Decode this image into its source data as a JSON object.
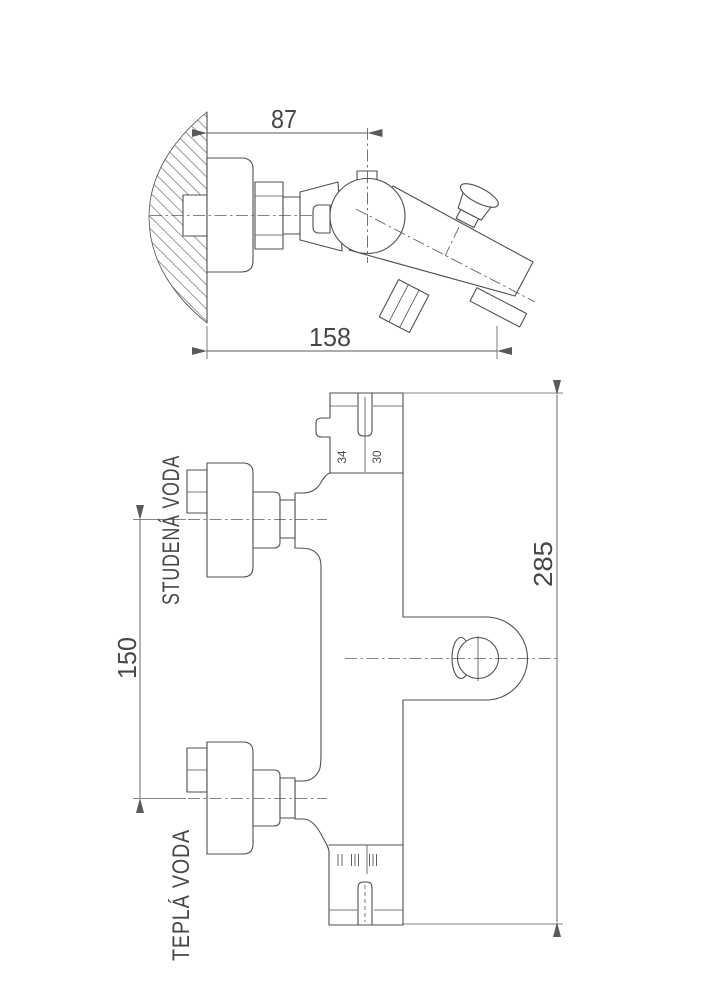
{
  "drawing": {
    "line_color": "#4f4f4f",
    "dim_color": "#5a5a5a",
    "background": "#ffffff"
  },
  "side_view": {
    "dims": {
      "wall_to_valve_center": "87",
      "total_depth": "158"
    }
  },
  "front_view": {
    "dims": {
      "inlet_spacing": "150",
      "total_height": "285",
      "cartridge_left": "34",
      "cartridge_right": "30"
    },
    "labels": {
      "cold_inlet": "STUDENÁ VODA",
      "hot_inlet": "TEPLÁ VODA"
    }
  }
}
